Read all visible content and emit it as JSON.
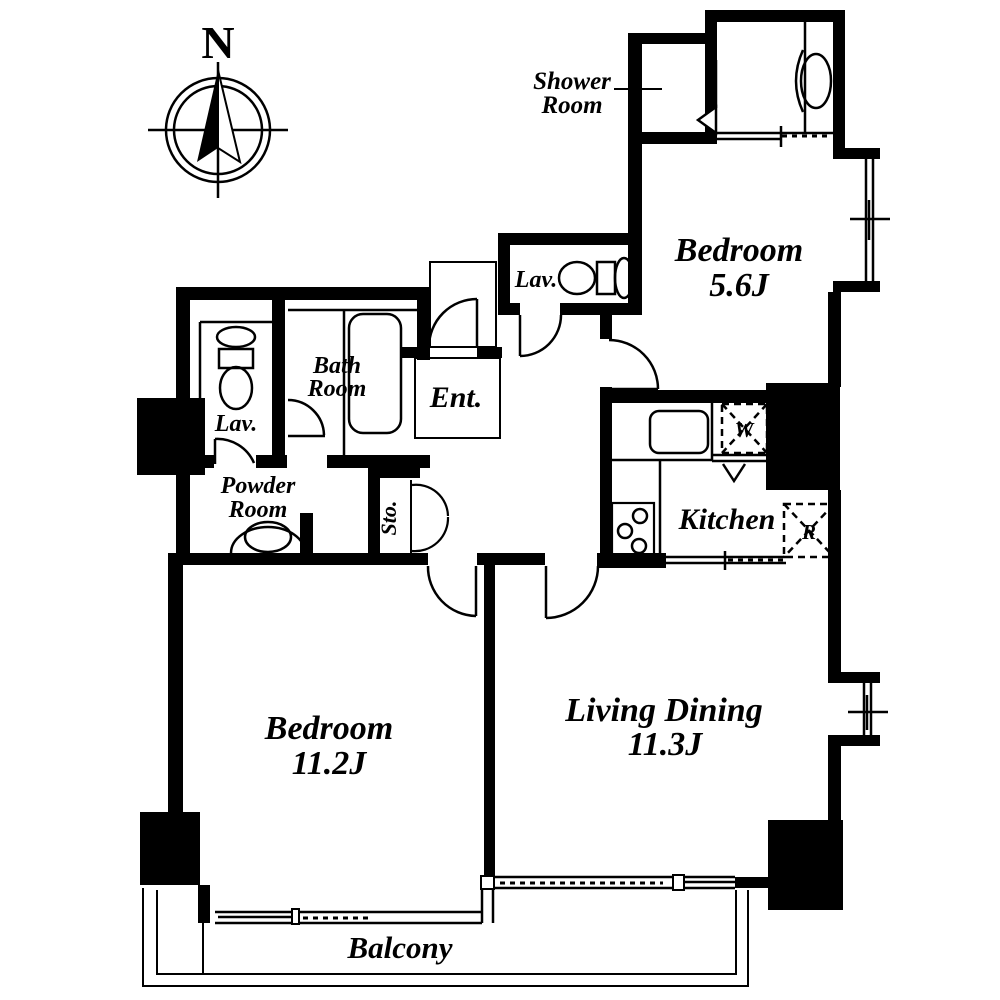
{
  "page": {
    "background": "#ffffff",
    "wall_color": "#000000",
    "text_color": "#000000"
  },
  "compass": {
    "north_label": "N"
  },
  "rooms": {
    "shower_room": {
      "line1": "Shower",
      "line2": "Room"
    },
    "lav_upper": {
      "label": "Lav."
    },
    "bedroom_small": {
      "name_line": "Bedroom",
      "size_line": "5.6J"
    },
    "bath_room": {
      "line1": "Bath",
      "line2": "Room"
    },
    "lav_left": {
      "label": "Lav."
    },
    "powder_room": {
      "line1": "Powder",
      "line2": "Room"
    },
    "entrance": {
      "label": "Ent."
    },
    "storage": {
      "label": "Sto."
    },
    "kitchen": {
      "label": "Kitchen"
    },
    "bedroom_large": {
      "name_line": "Bedroom",
      "size_line": "11.2J"
    },
    "living_dining": {
      "name_line": "Living Dining",
      "size_line": "11.3J"
    },
    "balcony": {
      "label": "Balcony"
    }
  },
  "appliances": {
    "washer_label": "W",
    "refrigerator_label": "R"
  }
}
